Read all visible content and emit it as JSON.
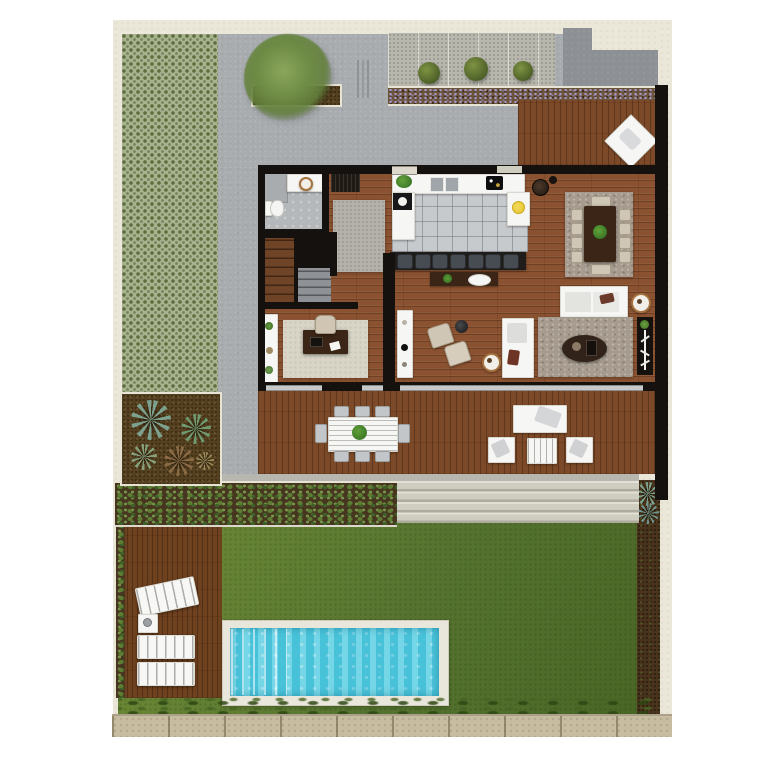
{
  "title": "villa-ground-floor-plan",
  "colors": {
    "page-bg": "#ffffff",
    "lot-cream": "#eae6d8",
    "concrete": "#a8acaf",
    "concrete-dark": "#8d9195",
    "wall": "#14110e",
    "wood-floor": "#8a5230",
    "wood-deck": "#7c4a28",
    "wood-pool-deck": "#6f421f",
    "tile": "#c7cacd",
    "water": "#55cde2",
    "lawn-light": "#6f8c36",
    "lawn-dark": "#4a6626",
    "trellis-base": "#a9b28e",
    "trellis-dot": "#5c6f3e",
    "lavender": "#a79ac4",
    "mulch": "#55401f",
    "hedge-green": "#5d7d33",
    "stone-steps": "#d0cdc1",
    "stone-wall": "#c7bc9f",
    "rug-gray": "#b4b1aa",
    "rug-taupe": "#a69b8e",
    "rug-beige": "#d8d4c6",
    "furniture-white": "#f6f6f4",
    "furniture-dark": "#3a2516",
    "chair-beige": "#cfc6b5",
    "bush-green": "#55682c",
    "palm-green": "#7ca28f",
    "lemon-yellow": "#e5c32b",
    "ring-brown": "#a5713f"
  },
  "counts": {
    "kitchen_island_stools": 7,
    "dining_side_chairs_per_side": 4,
    "dining_end_chairs": 2,
    "terrace_table_chairs_top": 3,
    "terrace_table_chairs_bottom": 3,
    "pool_loungers": 3,
    "garden_bushes": 3,
    "stone_step_treads": 4,
    "outdoor_lounge_armchairs": 2
  }
}
